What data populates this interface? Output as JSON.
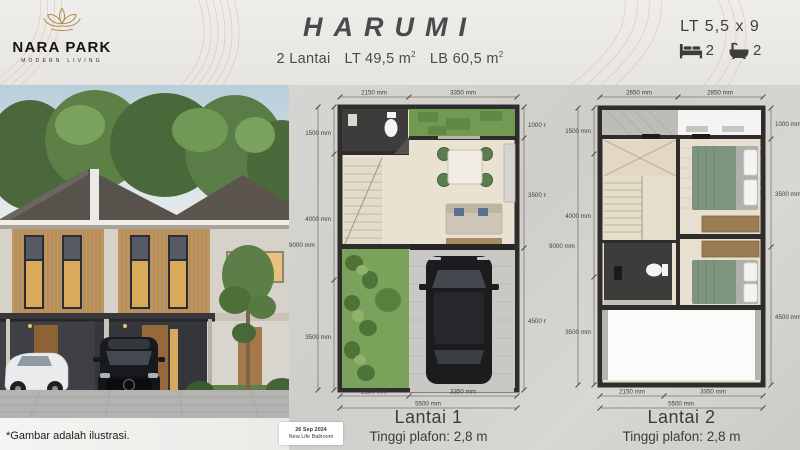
{
  "header": {
    "brand": "NARA PARK",
    "tagline": "MODERN LIVING",
    "title": "HARUMI",
    "specs": {
      "floors": "2 Lantai",
      "lt": "LT 49,5 m",
      "lb": "LB 60,5 m",
      "sup": "2"
    },
    "lot_size": "LT 5,5 x 9",
    "bedrooms": "2",
    "bathrooms": "2"
  },
  "photo": {
    "caption": "*Gambar adalah ilustrasi."
  },
  "stamp": {
    "date": "26 Sep 2024",
    "venue": "New Life Ballroom"
  },
  "plans": {
    "lantai1": {
      "title": "Lantai 1",
      "ceiling": "Tinggi plafon: 2,8 m",
      "dims": {
        "top": [
          "2150 mm",
          "3350 mm"
        ],
        "bottom": [
          "2150 mm",
          "3350 mm"
        ],
        "bottom_total": "5500 mm",
        "left": [
          "1500 mm",
          "4000 mm",
          "3500 mm"
        ],
        "left_total": "9000 mm",
        "right": [
          "1000 mm",
          "3500 mm",
          "4500 mm"
        ]
      }
    },
    "lantai2": {
      "title": "Lantai 2",
      "ceiling": "Tinggi plafon: 2,8 m",
      "dims": {
        "top": [
          "2650 mm",
          "2850 mm"
        ],
        "bottom": [
          "2150 mm",
          "3350 mm"
        ],
        "bottom_total": "5500 mm",
        "left": [
          "1500 mm",
          "4000 mm",
          "3500 mm"
        ],
        "left_total": "9000 mm",
        "right": [
          "1000 mm",
          "3500 mm",
          "4500 mm"
        ]
      }
    }
  },
  "colors": {
    "gold": "#b3924f",
    "wall": "#2e2d2b",
    "grass": "#719b52",
    "text": "#474747"
  }
}
